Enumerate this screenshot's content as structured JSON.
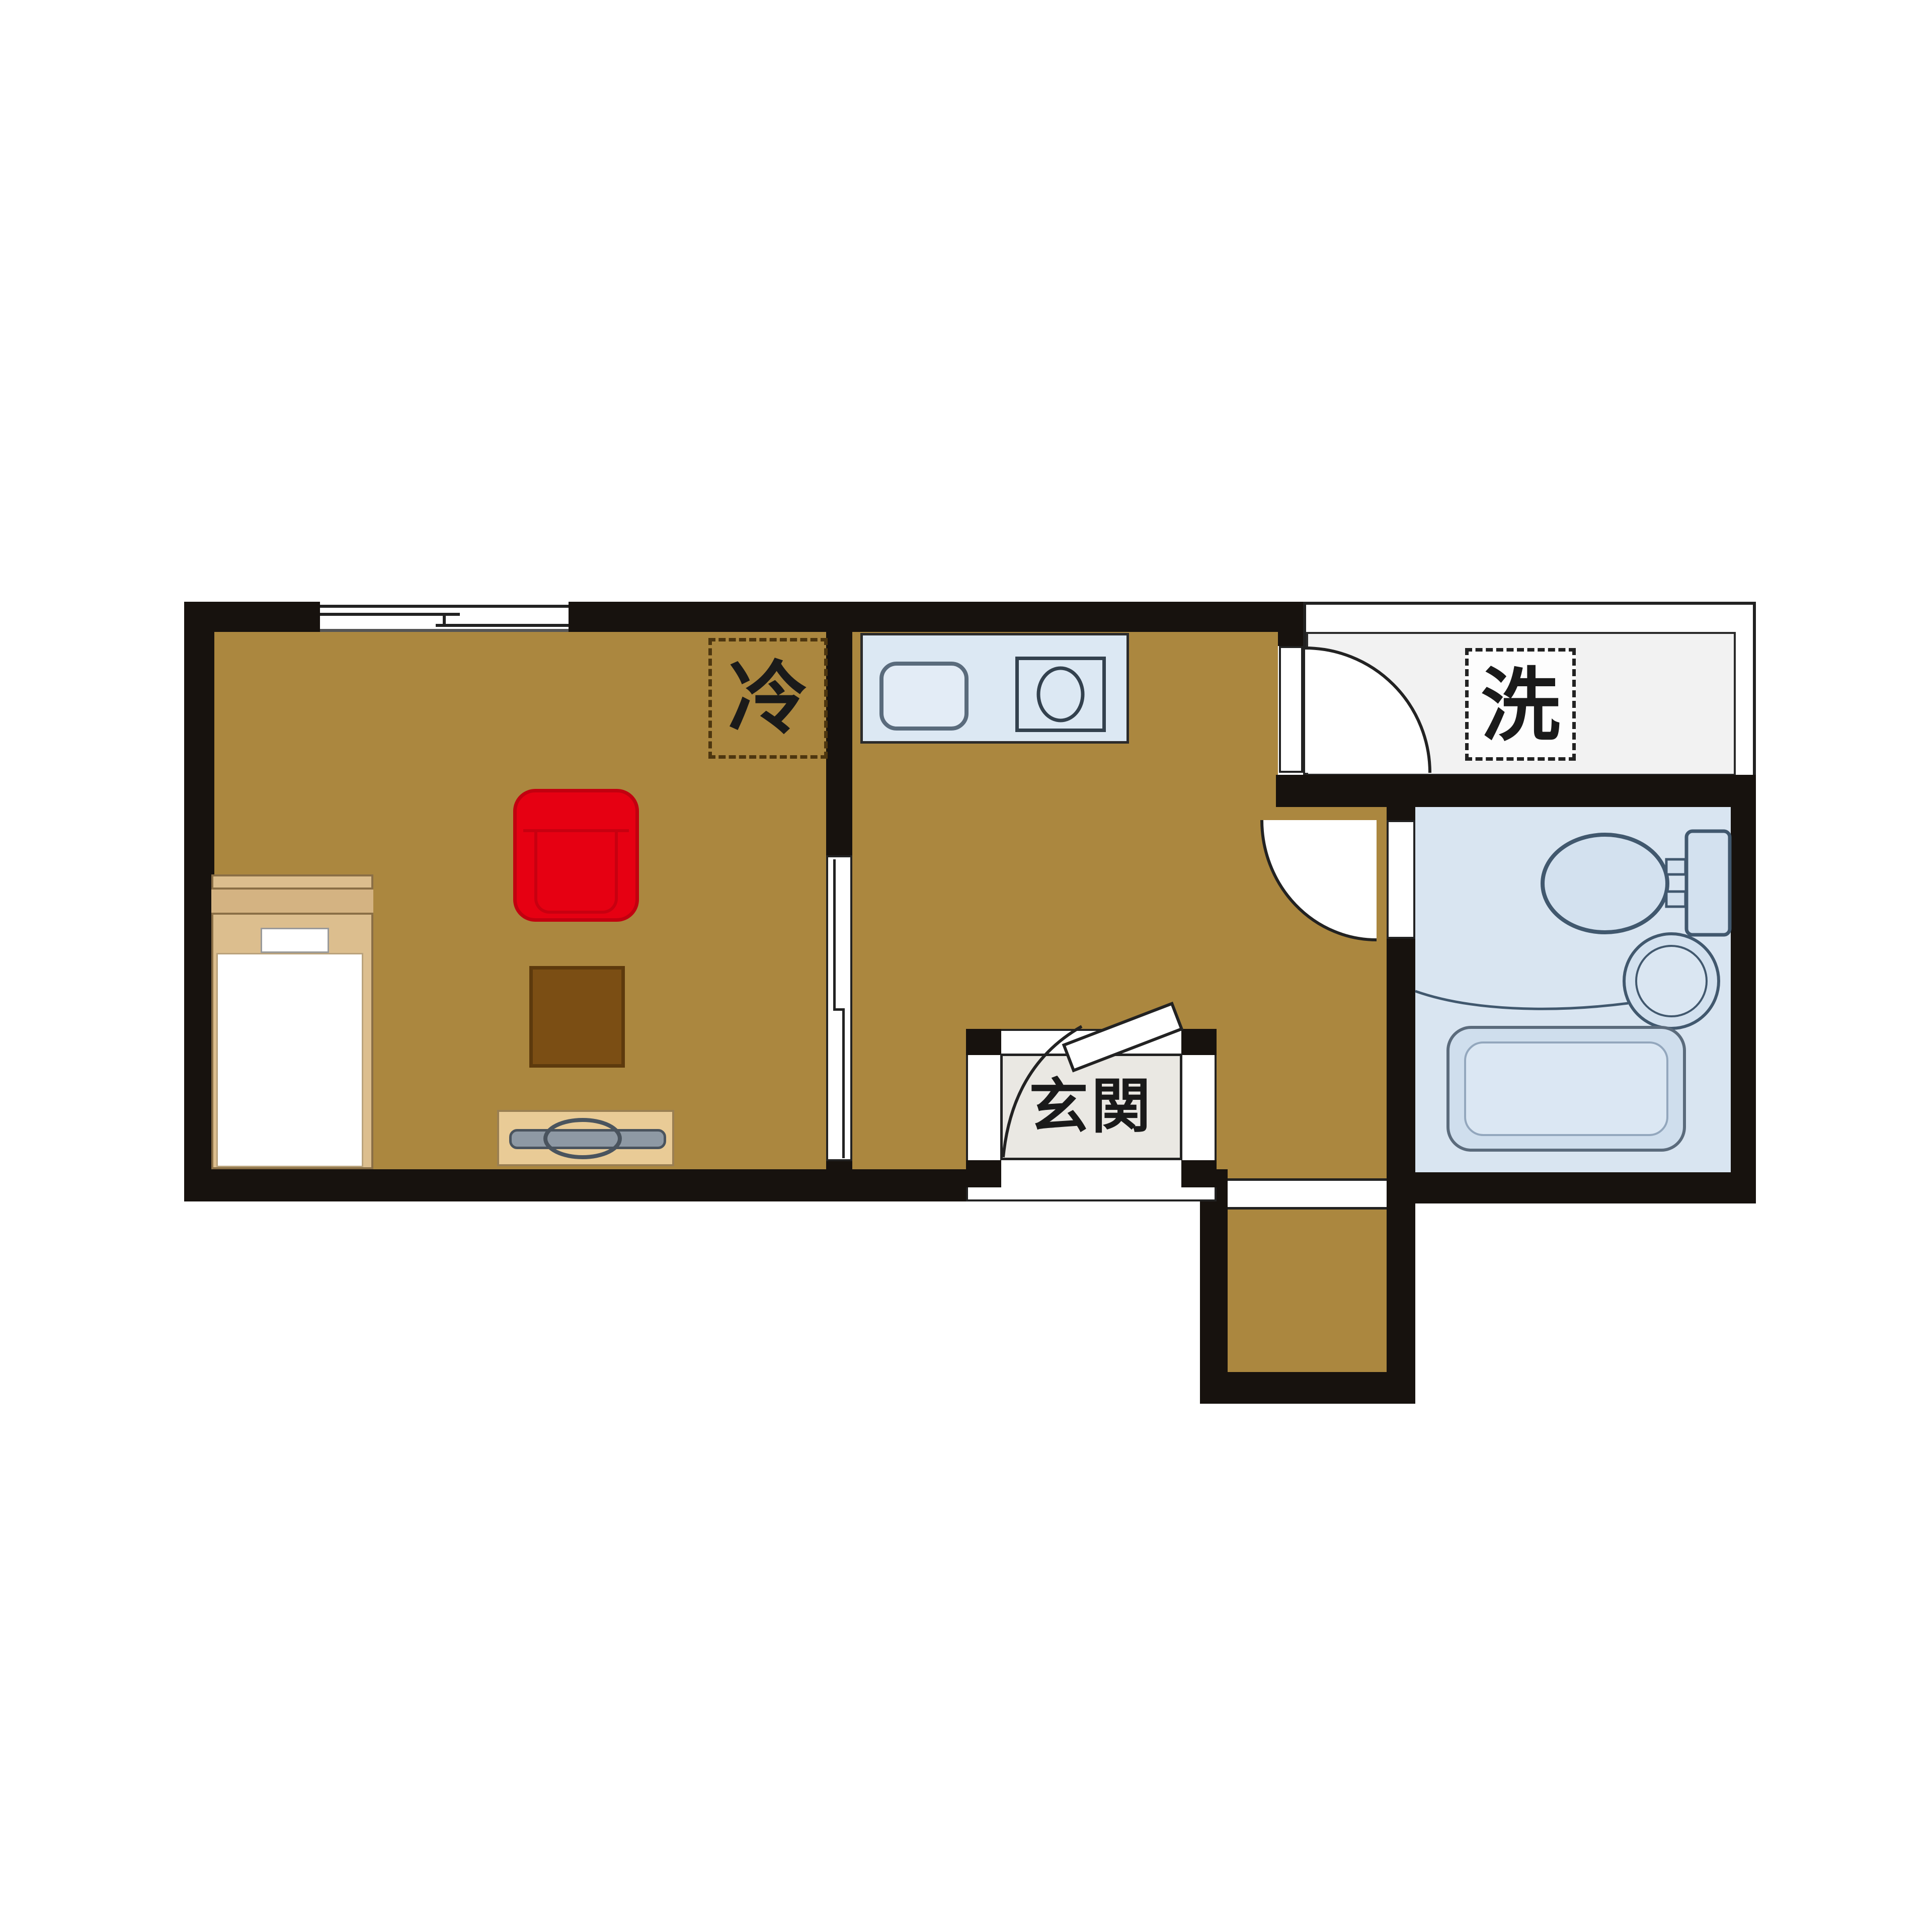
{
  "labels": {
    "refrigerator": "冷",
    "washing_machine": "洗",
    "entrance": "玄関"
  },
  "colors": {
    "wall": "#17120e",
    "flooring": "#ab873f",
    "hallway_floor": "#f2f2f2",
    "genkan_floor": "#eae8e3",
    "bathroom_floor": "#d9e5f1",
    "fixture_fill": "#d3e1ef",
    "fixture_outline": "#41586e",
    "kitchen_counter": "#dce8f3",
    "armchair_red": "#e60012",
    "low_table_brown": "#7b4e14",
    "bed_frame_tan": "#dcbe8e",
    "tv_board_tan": "#e9cb96",
    "tv_gray": "#8e99a4"
  }
}
